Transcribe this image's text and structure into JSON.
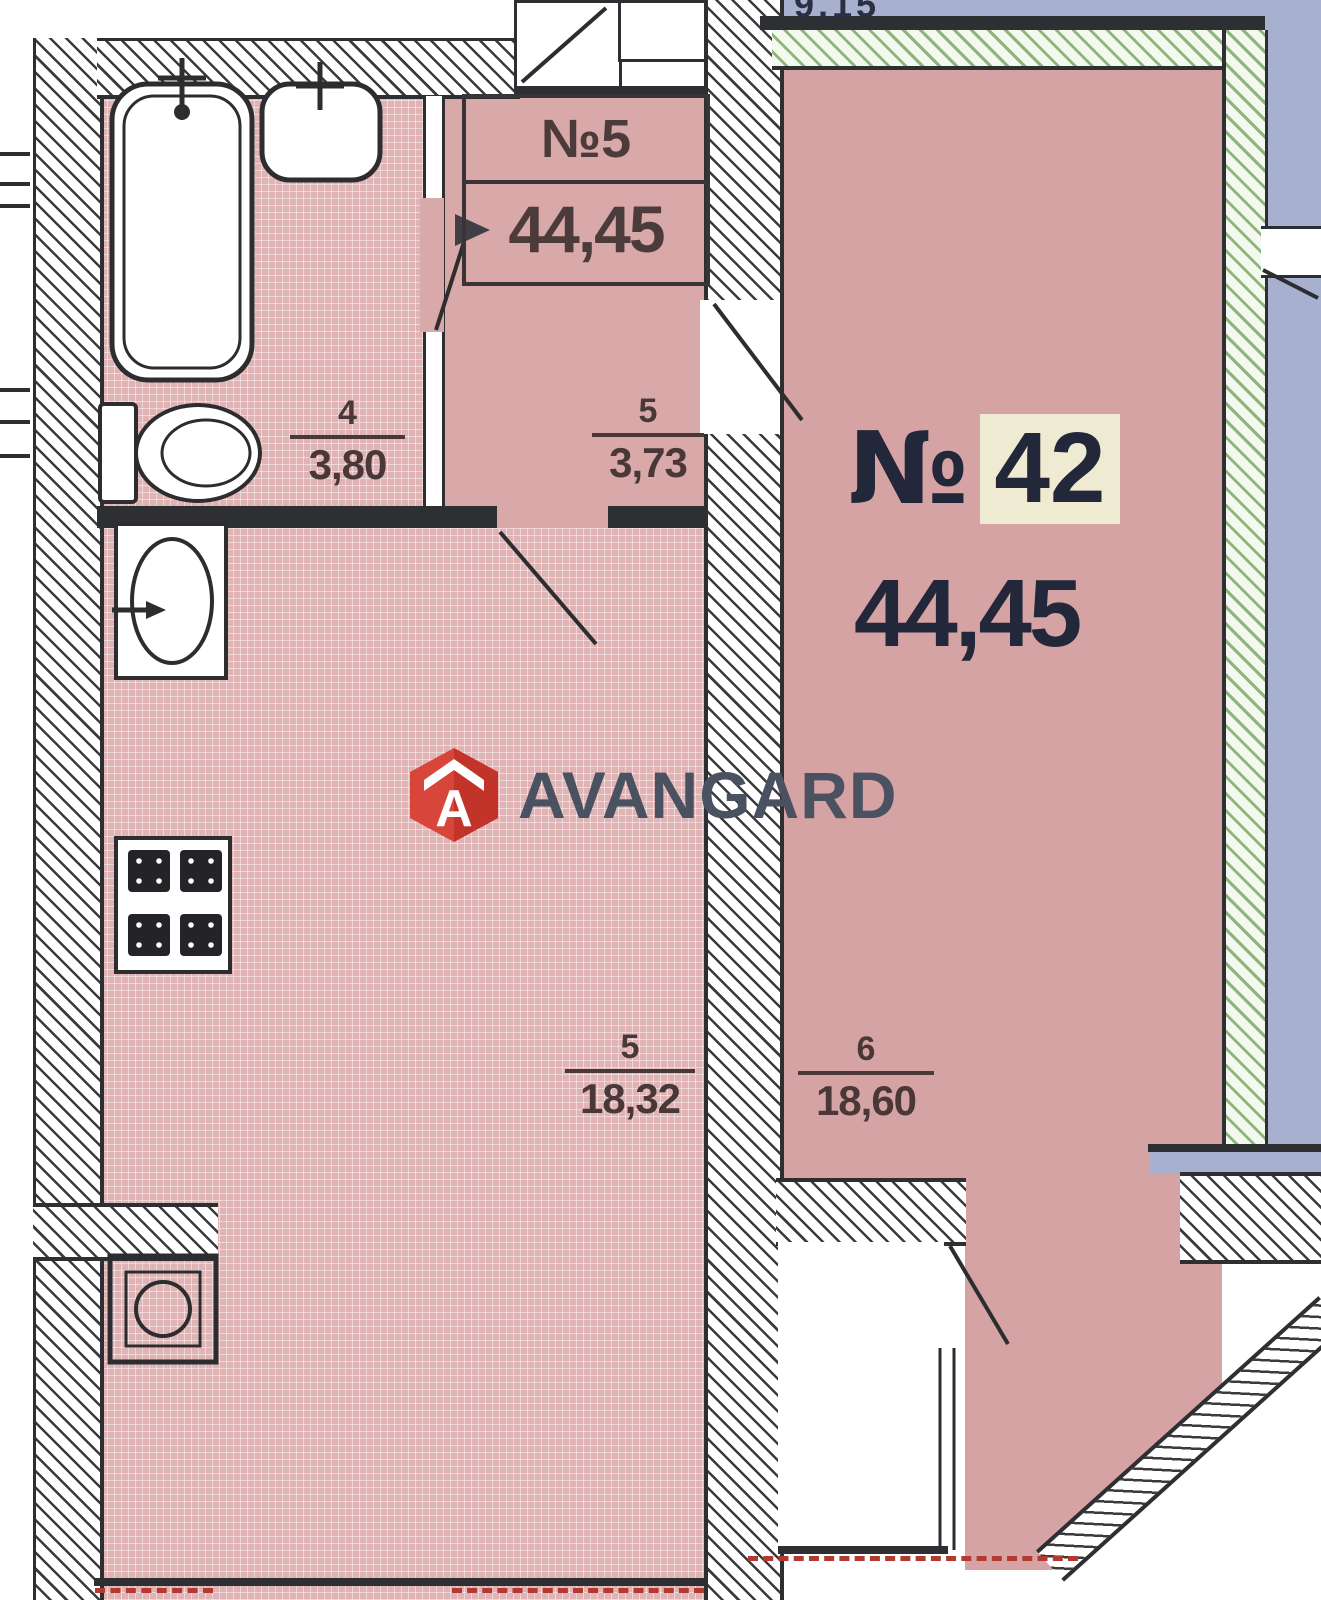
{
  "plan": {
    "apartment_box": {
      "number": "№5",
      "area": "44,45"
    },
    "apartment_callout": {
      "number_sign": "№",
      "number": "42",
      "area": "44,45"
    },
    "rooms": [
      {
        "name": "bathroom",
        "number": "4",
        "area": "3,80"
      },
      {
        "name": "hall",
        "number": "5",
        "area": "3,73"
      },
      {
        "name": "kitchen-living",
        "number": "5",
        "area": "18,32"
      },
      {
        "name": "room",
        "number": "6",
        "area": "18,60"
      }
    ],
    "partial_top_dimension": "9,15"
  },
  "watermark": {
    "brand": "AVANGARD",
    "logo_letter": "A"
  },
  "colors": {
    "floor_pink": "#d9a8a8",
    "floor_tile": "#e0b4b4",
    "room_pink": "#d6a3a5",
    "outside_blue": "#a7b0ce",
    "exterior_wall_green": "#8db57c",
    "wall_dark": "#2e2f33",
    "callout_highlight": "#efead2",
    "logo_red": "#d8453a",
    "logo_text": "#4a5160",
    "balcony_dashed_red": "#b23a32"
  }
}
